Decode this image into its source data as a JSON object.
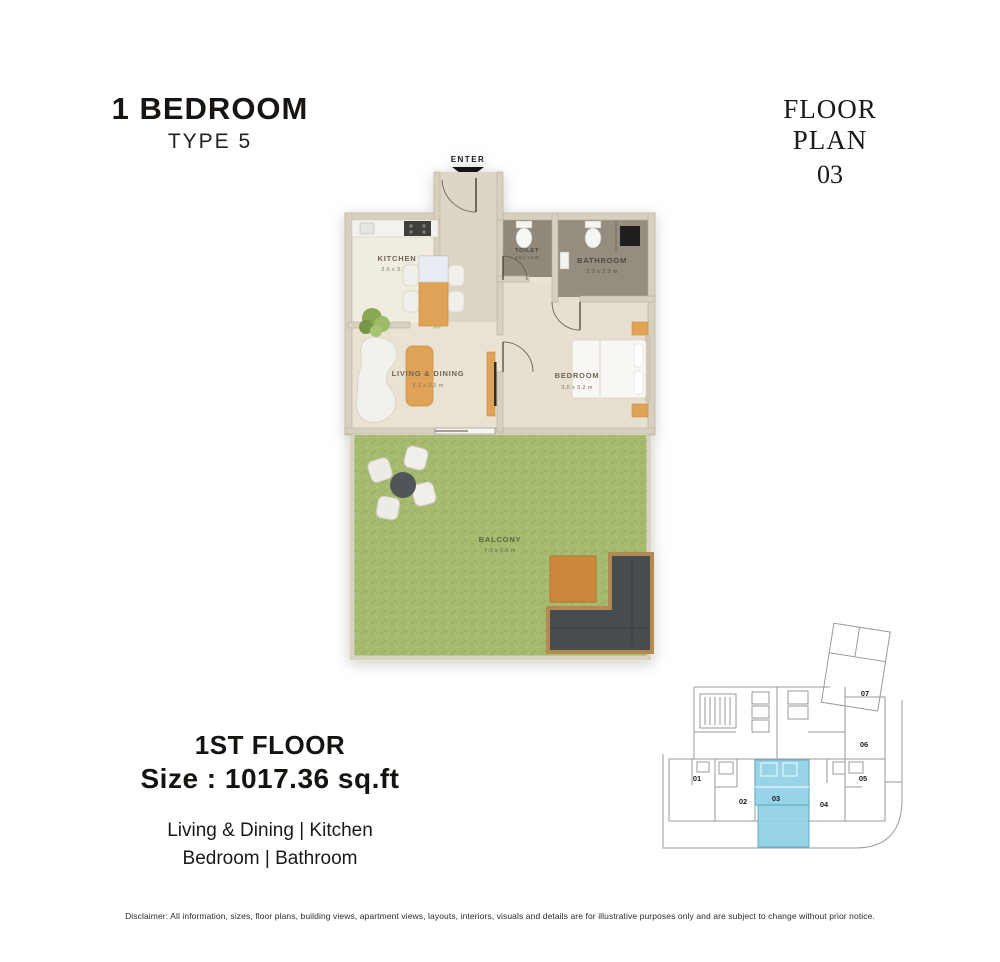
{
  "header": {
    "title": "1 BEDROOM",
    "subtitle": "TYPE 5"
  },
  "plan_ref": {
    "label": "FLOOR PLAN",
    "number": "03"
  },
  "floor_plan": {
    "enter_label": "ENTER",
    "rooms": {
      "kitchen": {
        "label": "KITCHEN",
        "dims": "2.6 x 3.3 m"
      },
      "toilet": {
        "label": "TOILET",
        "dims": "1.6 x 1.2 m"
      },
      "bathroom": {
        "label": "BATHROOM",
        "dims": "2.0 x 2.3 m"
      },
      "living": {
        "label": "LIVING & DINING",
        "dims": "3.3 x 3.1 m"
      },
      "bedroom": {
        "label": "BEDROOM",
        "dims": "3.0 x 3.2 m"
      },
      "balcony": {
        "label": "BALCONY",
        "dims": "7.0 x 5.6 m"
      }
    }
  },
  "details": {
    "floor": "1ST FLOOR",
    "size": "Size : 1017.36 sq.ft",
    "rooms_line1": "Living & Dining | Kitchen",
    "rooms_line2": "Bedroom | Bathroom"
  },
  "key_plan": {
    "units": [
      "01",
      "02",
      "03",
      "04",
      "05",
      "06",
      "07"
    ],
    "highlighted_unit": "03",
    "highlight_color": "#8ed0e6"
  },
  "disclaimer": "Disclaimer: All information, sizes, floor plans, building views, apartment views, layouts, interiors, visuals and details are for illustrative purposes only and are subject to change without prior notice.",
  "colors": {
    "wall": "#d7d0bf",
    "floor": "#eae3d4",
    "wet_floor": "#91897b",
    "balcony_green": "#a5b96f",
    "accent_wood": "#dfa257",
    "keyplan_line": "#999999"
  }
}
